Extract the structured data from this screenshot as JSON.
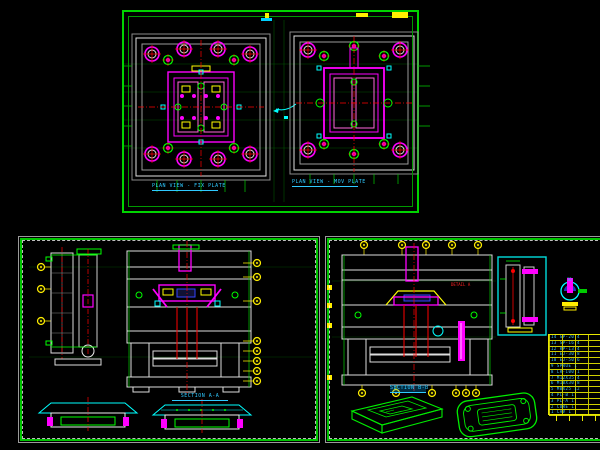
{
  "drawing": {
    "background_color": "#000000",
    "palette": {
      "line_green": "#00ff00",
      "magenta": "#ff00ff",
      "cyan": "#00ffff",
      "yellow": "#ffff00",
      "red": "#ff0000",
      "white": "#e8e8e8",
      "grey": "#9a9a9a"
    },
    "sheets": {
      "top": {
        "left_view_label": "PLAN VIEW - FIX PLATE",
        "right_view_label": "PLAN VIEW - MOV PLATE"
      },
      "bottom_left": {
        "section_label": "SECTION A-A"
      },
      "bottom_right": {
        "section_label": "SECTION B-B",
        "detail_label": "DETAIL A",
        "iso_label": "3D",
        "parts_table_rows": [
          "14 GP-20 4",
          "13 SP-16 4",
          "12 RP-13 4",
          "11 EJ-30 8",
          "10 EJ-50 6",
          "9 SPRUE 1",
          "8 LR-100 1",
          "7 M12X35 4",
          "6 M10X30 8",
          "5 M8X25 12",
          "4 PL-B 1",
          "3 PL-A 1",
          "2 CORE 1",
          "1 CAV 1"
        ]
      }
    }
  }
}
